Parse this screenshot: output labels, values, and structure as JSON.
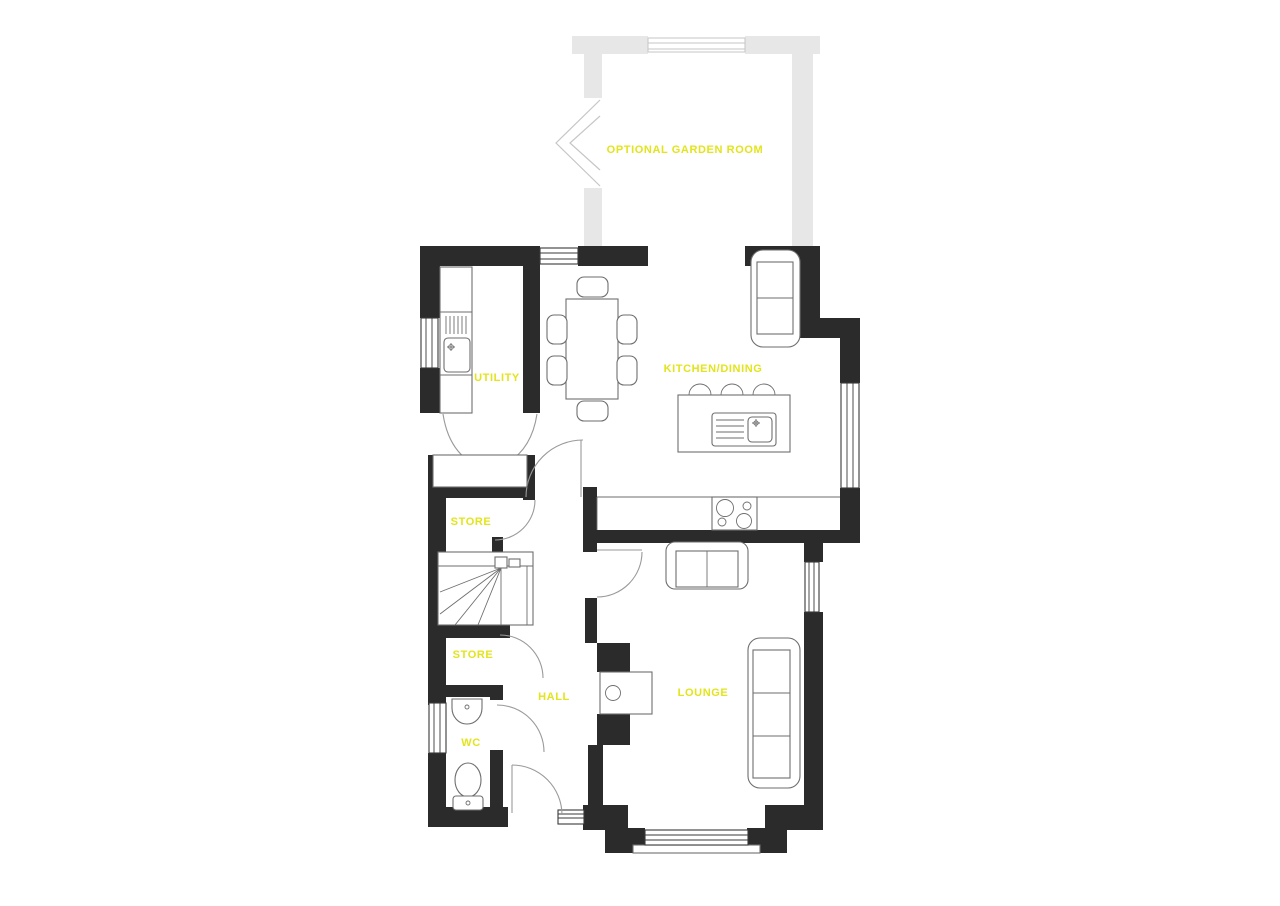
{
  "document": {
    "type": "ground-floor-plan"
  },
  "colors": {
    "wall": "#2b2b2b",
    "optional_wall": "#e7e7e7",
    "room_label": "#e2e41c",
    "furniture_line": "#6e6e6e",
    "door_swing": "#9a9a9a",
    "background": "#ffffff"
  },
  "rooms": [
    {
      "name": "optional-garden-room",
      "label": "OPTIONAL GARDEN ROOM",
      "optional": true
    },
    {
      "name": "utility",
      "label": "UTILITY"
    },
    {
      "name": "kitchen-dining",
      "label": "KITCHEN/DINING"
    },
    {
      "name": "store-upper",
      "label": "STORE"
    },
    {
      "name": "store-lower",
      "label": "STORE"
    },
    {
      "name": "hall",
      "label": "HALL"
    },
    {
      "name": "wc",
      "label": "WC"
    },
    {
      "name": "lounge",
      "label": "LOUNGE"
    }
  ],
  "furniture": [
    "dining-table-with-six-chairs",
    "kitchen-island-with-sink-and-three-stools",
    "hob-four-burners",
    "armchair-kitchen",
    "utility-counter-with-sink-and-drainer",
    "double-doors-utility",
    "staircase-with-winders",
    "store-shelf",
    "wash-basin",
    "toilet",
    "two-seat-sofa-lounge",
    "three-seat-sofa-lounge",
    "media-unit-log-burner",
    "bay-window-lounge",
    "front-door-with-sidelight"
  ]
}
